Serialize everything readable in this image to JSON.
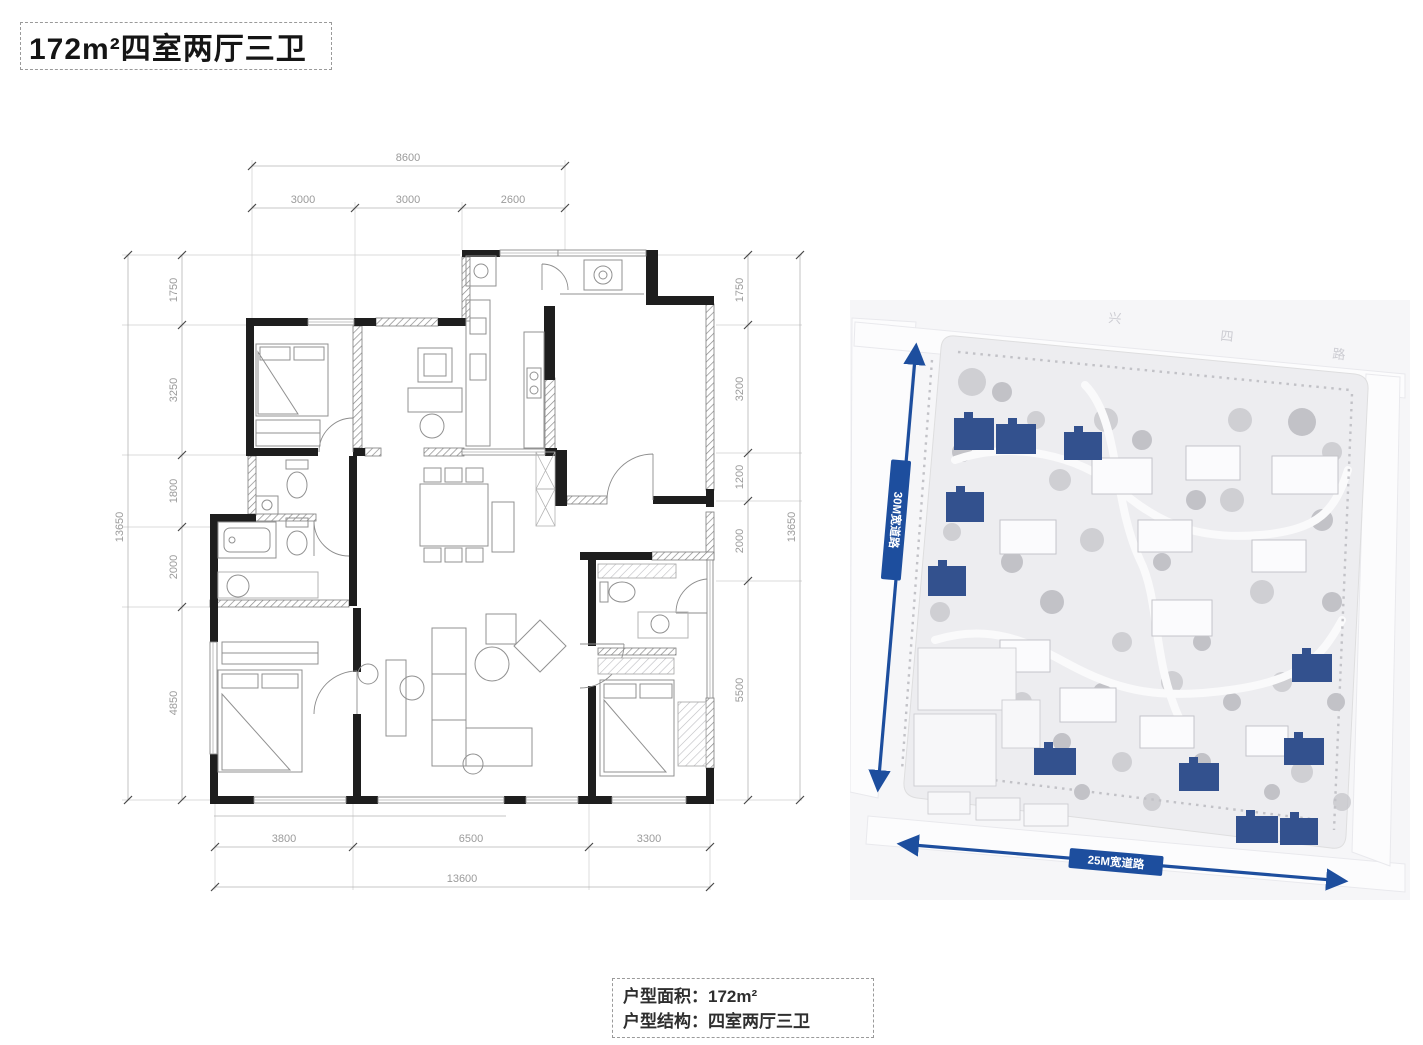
{
  "title": "172m²四室两厅三卫",
  "floor_plan": {
    "dims": {
      "top_total": "8600",
      "top": [
        "3000",
        "3000",
        "2600"
      ],
      "left_total": "13650",
      "left": [
        "1750",
        "3250",
        "1800",
        "2000",
        "4850"
      ],
      "right": [
        "1750",
        "3200",
        "1200",
        "2000",
        "5500"
      ],
      "right_total": "13650",
      "bottom": [
        "3800",
        "6500",
        "3300"
      ],
      "bottom_total": "13600"
    }
  },
  "site_plan": {
    "road_left_label": "30M宽道路",
    "road_bottom_label": "25M宽道路",
    "street_name_chars": [
      "兴",
      "四",
      "路"
    ],
    "colors": {
      "highlight_building": "#33518e",
      "road_arrow": "#1d4e9e"
    }
  },
  "info_box": {
    "area_label": "户型面积：",
    "area_value": "172m²",
    "structure_label": "户型结构：",
    "structure_value": "四室两厅三卫"
  }
}
